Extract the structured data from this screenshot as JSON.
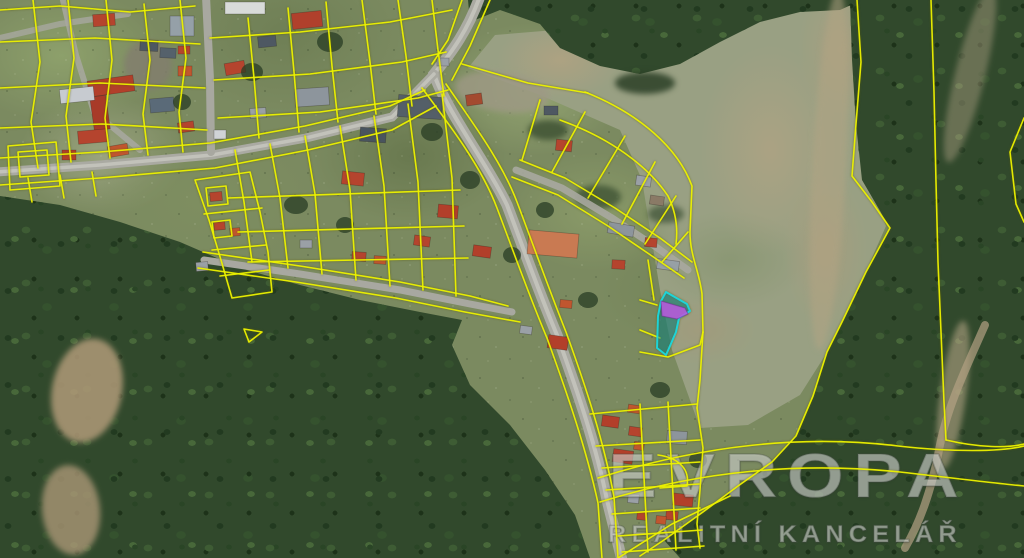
{
  "watermark": {
    "brand": "EVROPA",
    "subtitle": "REALITNÍ KANCELÁŘ"
  },
  "map": {
    "kind": "aerial-orthophoto-with-cadastral-overlay",
    "highlighted_parcel": "selected-parcel"
  },
  "colors": {
    "parcel_line": "#edf200",
    "highlight_teal_fill": "rgba(0,140,160,0.5)",
    "highlight_teal_stroke": "#1ad8e0",
    "highlight_purple": "#b95be0",
    "road": "#aaaaa2",
    "forest": "#31492c",
    "meadow": "#99a083",
    "roof_red": "#b23f2a"
  }
}
